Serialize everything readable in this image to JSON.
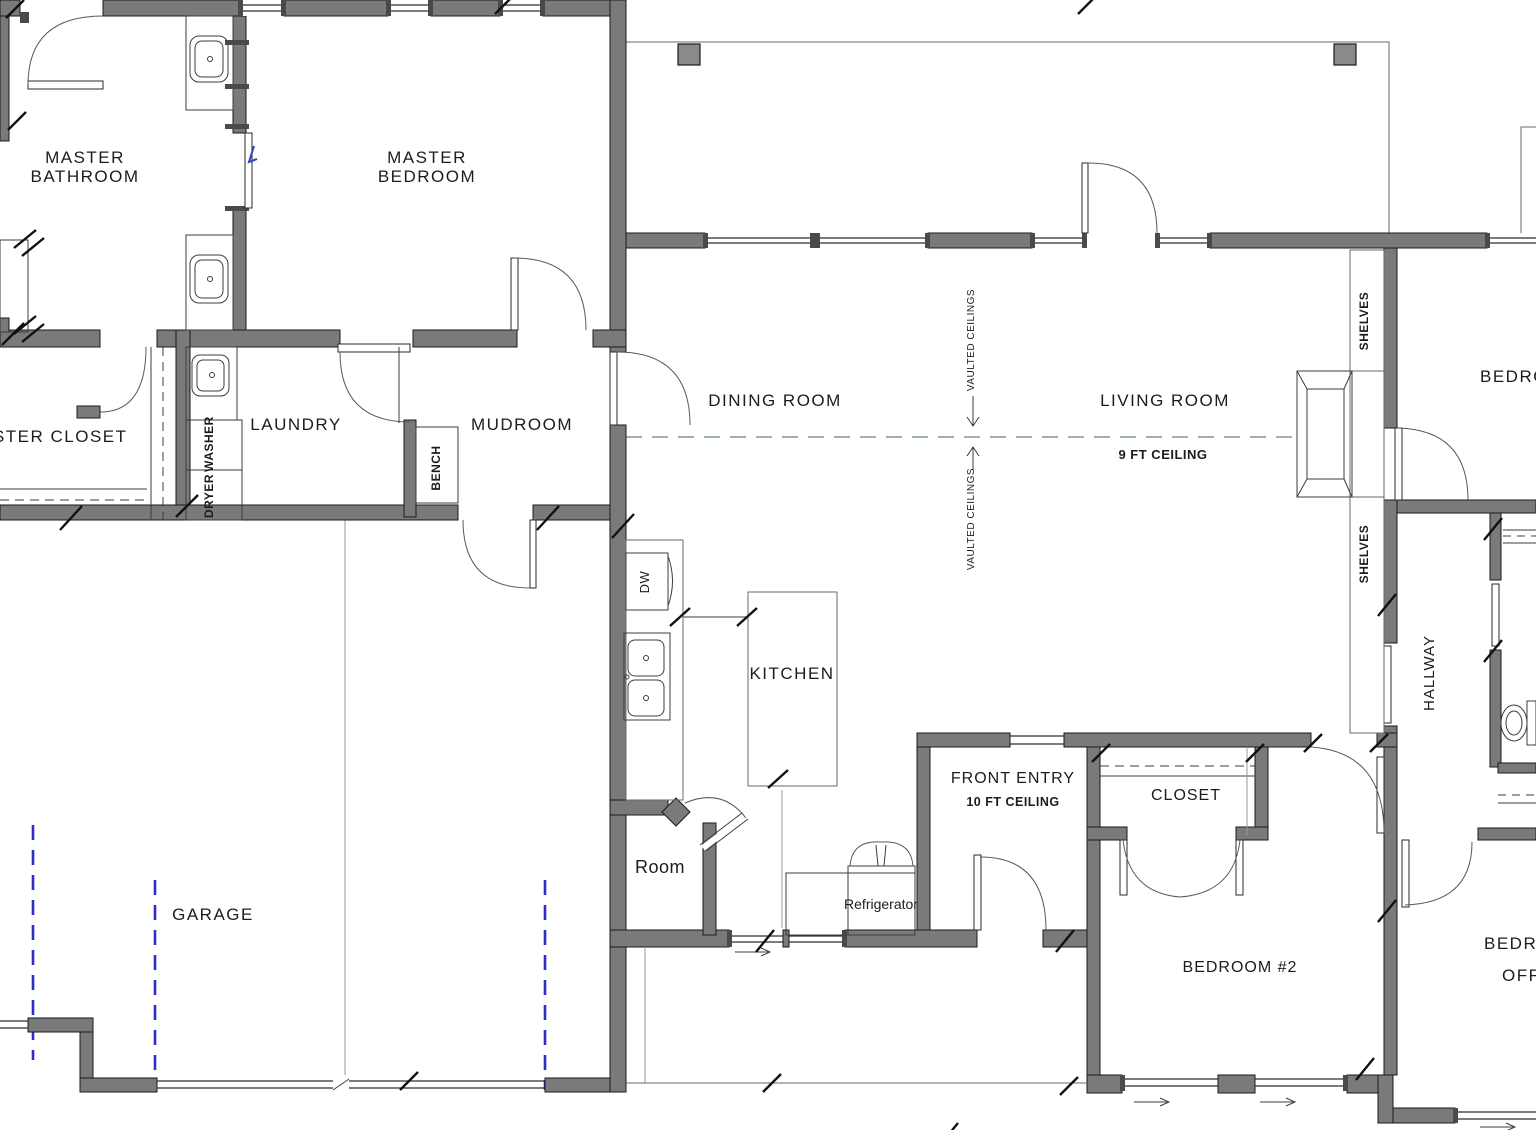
{
  "drawing": {
    "type": "residential-floor-plan",
    "rooms": {
      "master_bathroom_l1": "MASTER",
      "master_bathroom_l2": "BATHROOM",
      "master_bedroom_l1": "MASTER",
      "master_bedroom_l2": "BEDROOM",
      "master_closet": "MASTER CLOSET",
      "laundry": "LAUNDRY",
      "mudroom": "MUDROOM",
      "dining_room": "DINING ROOM",
      "living_room": "LIVING ROOM",
      "kitchen": "KITCHEN",
      "garage": "GARAGE",
      "pantry_room": "Room",
      "front_entry": "FRONT ENTRY",
      "hall_closet": "CLOSET",
      "bedroom_2": "BEDROOM #2",
      "hallway": "HALLWAY",
      "bedroom_right": "BEDROOM",
      "bedroom_office_l1": "BEDROOM",
      "bedroom_office_l2": "OFFICE"
    },
    "annotations": {
      "nine_ft_ceiling": "9 FT CEILING",
      "ten_ft_ceiling": "10 FT CEILING",
      "vaulted_ceilings": "VAULTED CEILINGS",
      "shelves": "SHELVES",
      "bench": "BENCH",
      "dw": "DW",
      "washer": "WASHER",
      "dryer": "DRYER",
      "refrigerator": "Refrigerator"
    },
    "colors": {
      "wall_fill": "#7a7a7a",
      "ridge_dashed_line": "#9cb49c",
      "garage_track_dashed": "#2a2ec4",
      "pocket_door_mark": "#3344bb",
      "background": "#ffffff"
    }
  }
}
